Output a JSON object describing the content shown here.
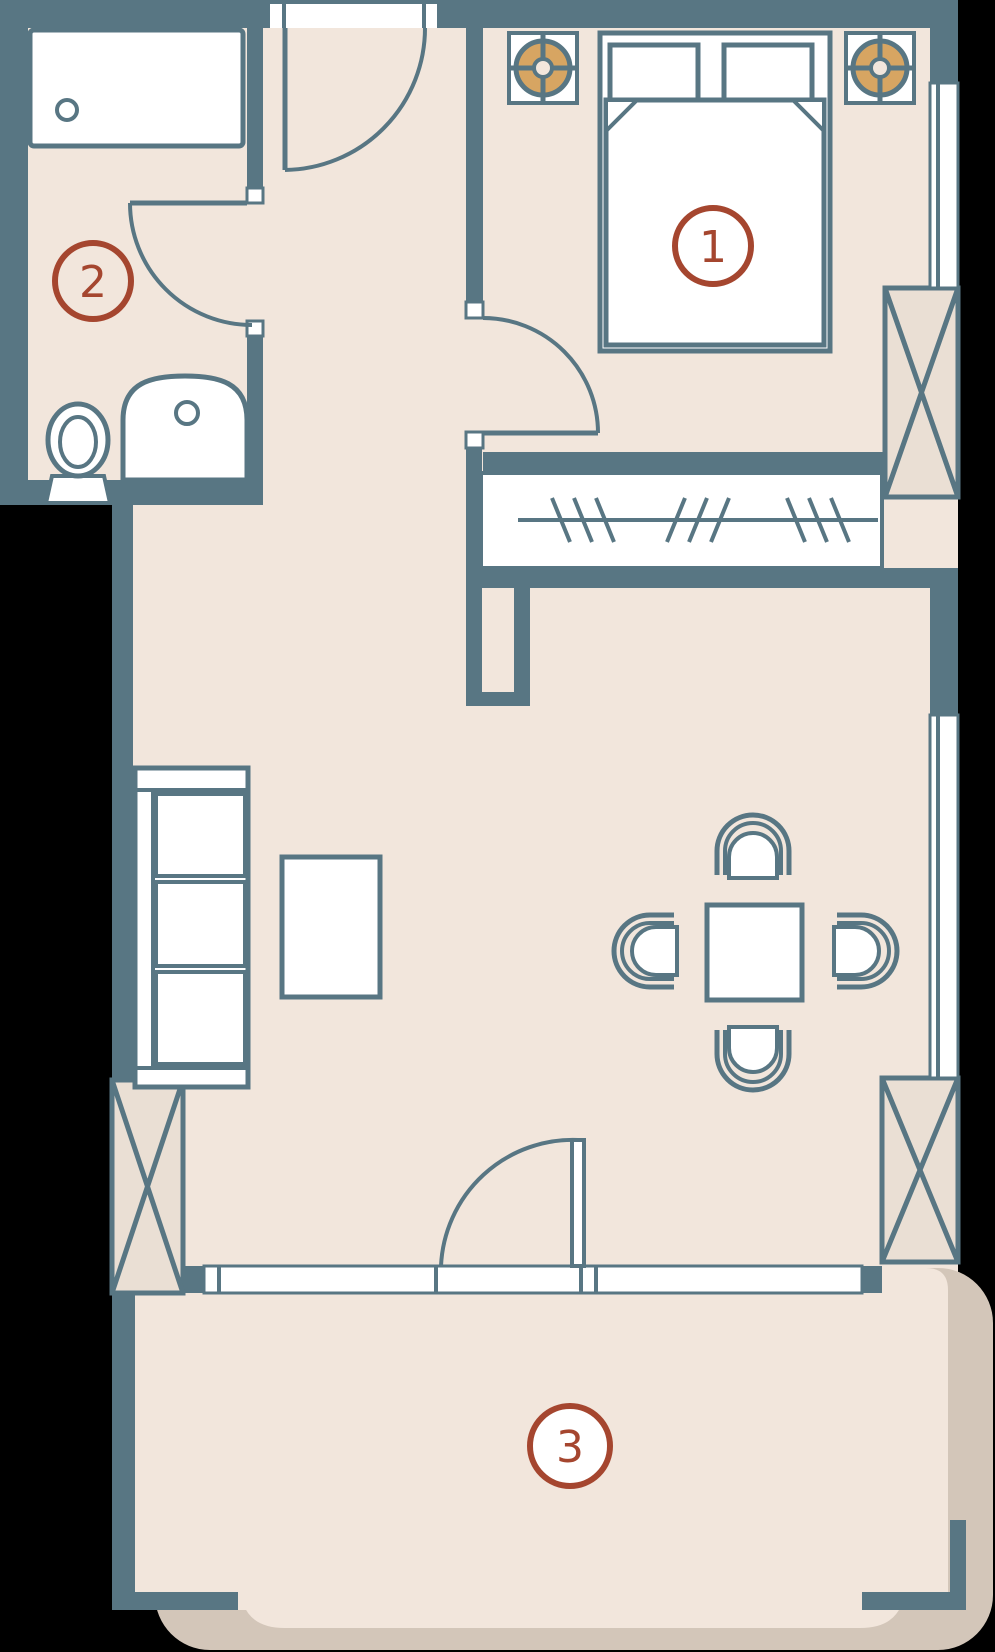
{
  "plan": {
    "labels": [
      {
        "value": "1",
        "fill": "none"
      },
      {
        "value": "2",
        "fill": "none"
      },
      {
        "value": "3",
        "fill": "#ffffff"
      }
    ]
  },
  "colors": {
    "wall": "#587683",
    "floor": "#f2e6dc",
    "shadow": "#d3c6b9",
    "column_fill": "#eadfd4",
    "lamp": "#d7a562",
    "accent": "#a5462f",
    "white": "#ffffff",
    "background": "#000000"
  },
  "symbols": [
    "double-bed",
    "pillow",
    "nightstand",
    "ceiling-lamp",
    "bathtub",
    "toilet",
    "sink",
    "wardrobe-rail",
    "sofa",
    "coffee-table",
    "dining-table",
    "dining-chair",
    "window",
    "door-swing",
    "structural-column",
    "balcony-slab"
  ]
}
